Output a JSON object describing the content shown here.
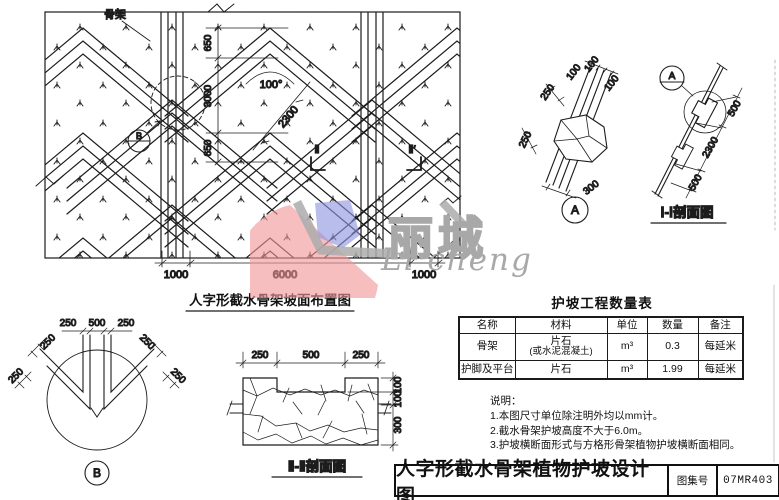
{
  "plan": {
    "caption": "人字形截水骨架坡面布置图",
    "skeleton_label": "骨架",
    "angle": "100°",
    "dim_650a": "650",
    "dim_3000": "3000",
    "dim_650b": "650",
    "dim_2300": "2300",
    "dim_1000a": "1000",
    "dim_6000": "6000",
    "dim_1000b": "1000",
    "mark_b": "B",
    "sec_left": "Ⅱ",
    "sec_right": "Ⅱ′"
  },
  "detail_a": {
    "mark": "A",
    "d250a": "250",
    "d250b": "250",
    "d100a": "100",
    "d100b": "100",
    "d100c": "100",
    "d300": "300"
  },
  "section_i": {
    "caption": "Ⅰ-Ⅰ剖面图",
    "mark": "A",
    "d2300": "2300",
    "d500a": "500",
    "d500b": "500"
  },
  "detail_b": {
    "mark": "B",
    "t250a": "250",
    "t500": "500",
    "t250b": "250",
    "l250a": "250",
    "l250b": "250",
    "r250a": "250",
    "r250b": "250"
  },
  "section_ii": {
    "caption": "Ⅱ-Ⅱ剖面图",
    "t250a": "250",
    "t500": "500",
    "t250b": "250",
    "r100a": "100",
    "r100b": "100",
    "r300": "300"
  },
  "table": {
    "title": "护坡工程数量表",
    "headers": [
      "名称",
      "材料",
      "单位",
      "数量",
      "备注"
    ],
    "rows": [
      {
        "name": "骨架",
        "material": "片石",
        "material2": "(或水泥混凝土)",
        "unit": "m³",
        "qty": "0.3",
        "remark": "每延米"
      },
      {
        "name": "护脚及平台",
        "material": "片石",
        "material2": "",
        "unit": "m³",
        "qty": "1.99",
        "remark": "每延米"
      }
    ]
  },
  "notes": {
    "heading": "说明：",
    "items": [
      "1.本图尺寸单位除注明外均以mm计。",
      "2.截水骨架护坡高度不大于6.0m。",
      "3.护坡横断面形式与方格形骨架植物护坡横断面相同。"
    ]
  },
  "title_block": {
    "title": "人字形截水骨架植物护坡设计图",
    "atlas_label": "图集号",
    "atlas_no": "07MR403"
  },
  "logo": {
    "cn": "丽城",
    "en": "Li cheng",
    "red": "#f19697",
    "blue": "#8d95de",
    "gray": "#a8a8a8"
  }
}
